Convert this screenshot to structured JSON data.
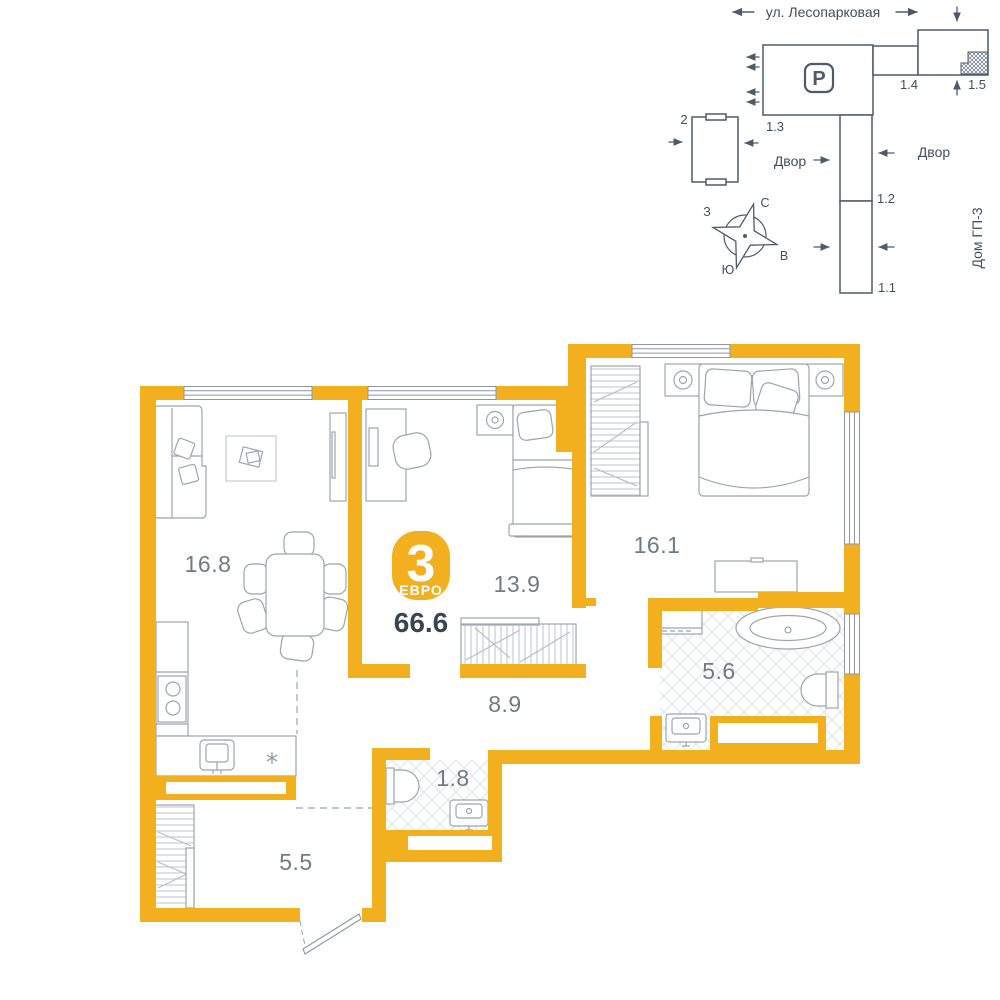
{
  "plan": {
    "badge": {
      "rooms": "3",
      "format": "ЕВРО"
    },
    "total_area": "66.6",
    "rooms": {
      "living": {
        "area": "16.8"
      },
      "bedroom2": {
        "area": "13.9"
      },
      "bedroom": {
        "area": "16.1"
      },
      "hallway": {
        "area": "8.9"
      },
      "bathroom": {
        "area": "5.6"
      },
      "wc": {
        "area": "1.8"
      },
      "entry": {
        "area": "5.5"
      }
    }
  },
  "site_plan": {
    "street": "ул. Лесопарковая",
    "parking": "Р",
    "buildings": {
      "b2": "2",
      "b13": "1.3",
      "b14": "1.4",
      "b15": "1.5",
      "b12": "1.2",
      "b11": "1.1"
    },
    "courtyard_left": "Двор",
    "courtyard_right": "Двор",
    "adjacent_house": "Дом ГП-3",
    "compass": {
      "north": "С",
      "south": "Ю",
      "west": "З",
      "east": "В"
    }
  },
  "colors": {
    "wall_accent": "#F2B01E",
    "site_lines": "#4C5B6C",
    "furniture_lines": "#9AA5B1",
    "area_text": "#6F7A86",
    "total_text": "#3B4450"
  }
}
